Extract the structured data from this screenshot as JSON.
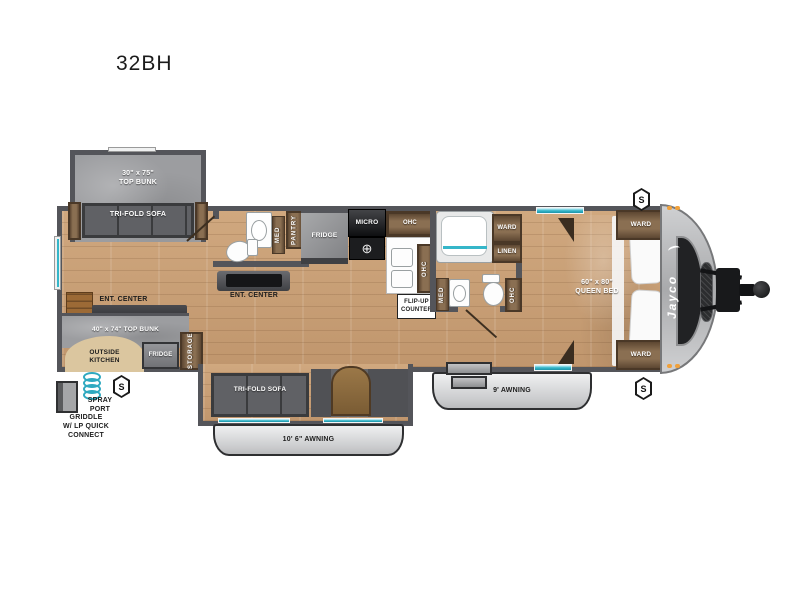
{
  "title": "32BH",
  "brand": {
    "logo": "Jayco"
  },
  "speakers": {
    "letter": "S"
  },
  "icons": {
    "burner": "⊕"
  },
  "rear_slide": {
    "bunk_size": "30\" x 75\"",
    "bunk_name": "TOP BUNK",
    "sofa": "TRI-FOLD SOFA"
  },
  "rear_living": {
    "ent_center": "ENT. CENTER"
  },
  "mid_bath": {
    "med": "MED",
    "pantry": "PANTRY"
  },
  "mid_ent": {
    "ent_center": "ENT. CENTER"
  },
  "kitchen": {
    "fridge": "FRIDGE",
    "micro": "MICRO",
    "ohc_top": "OHC",
    "ohc_side": "OHC",
    "flip_up_1": "FLIP-UP",
    "flip_up_2": "COUNTER"
  },
  "main_bath": {
    "ward": "WARD",
    "linen": "LINEN",
    "med": "MED",
    "ohc": "OHC"
  },
  "bedroom": {
    "bed_size": "60\" x 80\"",
    "bed_name": "QUEEN BED",
    "ward_top": "WARD",
    "ward_bottom": "WARD"
  },
  "garage": {
    "bunk": "40\" x 74\" TOP BUNK",
    "outside_1": "OUTSIDE",
    "outside_2": "KITCHEN",
    "fridge": "FRIDGE",
    "storage": "STORAGE"
  },
  "bottom_slide": {
    "sofa": "TRI-FOLD SOFA"
  },
  "exterior": {
    "awning_main": "10' 6\" AWNING",
    "awning_front": "9' AWNING",
    "spray_1": "SPRAY",
    "spray_2": "PORT",
    "griddle_1": "GRIDDLE",
    "griddle_2": "W/ LP QUICK",
    "griddle_3": "CONNECT"
  }
}
